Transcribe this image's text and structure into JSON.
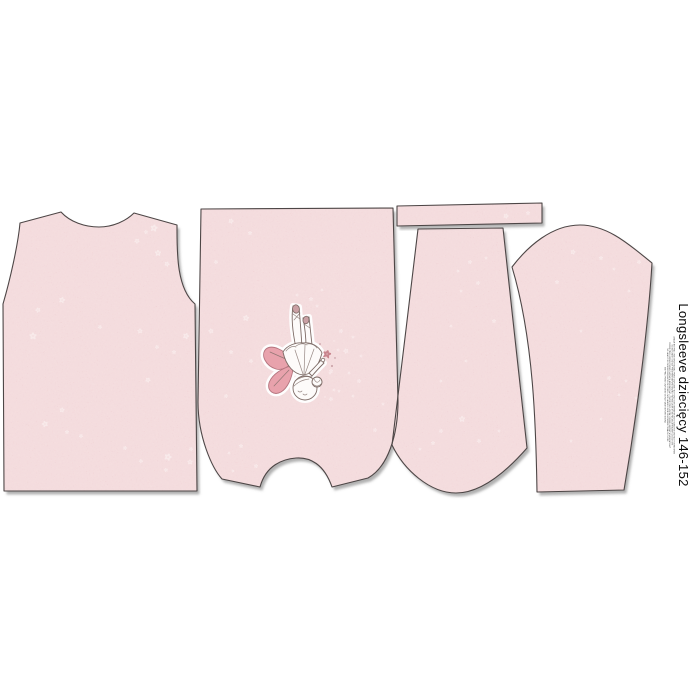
{
  "image": {
    "background": "#ffffff",
    "description": "Printed fabric sewing panel preview with cut pattern pieces"
  },
  "label": {
    "title": "Longsleeve dziecięcy 146-152",
    "care_lines": [
      "UWAGA! NIE PRAĆ I NIE DEKATYZOWAĆ PRZED USZYCIEM • ACHTUNG! VOR DEM NÄHEN NICHT WASCHEN UND NICHT DEKATIEREN",
      "DO NOT WASH / DO NOT PRESHRINK BEFORE SEWING • NE PAS LAVER ET NE PAS DÉCATIR AVANT LA COUTURE",
      "POZOR! PŘED UŠITÍM VÝROBKU NEPRAT A NEDEKATOVAT • POZOR! PRED UŠITÍM VÝROBKU NEPRAŤ A NEDEKATOVAŤ",
      "NO LAVAR Y NO DESENCOGER ANTES DE COSER • NON LAVARE E NON DECATIZZARE PRIMA DI CUCIRE",
      "NIE PRAĆ PRZED USZYCIEM / DO NOT WASH BEFORE SEWING"
    ]
  },
  "fabric": {
    "base_color": "#efc6c9",
    "star_stroke": "#f9ebec",
    "star_fill": "#f2d2d4",
    "outline_color": "#4d4646",
    "shadow_color": "#6f6f6f"
  },
  "fairy": {
    "wing_color": "#e8a2ac",
    "wing_outline": "#b5747e",
    "body_color": "#fdfbfa",
    "line_color": "#7d6b66",
    "wand_star_fill": "#f3c9ce",
    "wand_star_stroke": "#c9858e"
  },
  "stars": [
    [
      154,
      228,
      7,
      10
    ],
    [
      137,
      241,
      5,
      40
    ],
    [
      158,
      253,
      6,
      0
    ],
    [
      167,
      264,
      5,
      25
    ],
    [
      146,
      232,
      4,
      60
    ],
    [
      62,
      300,
      6,
      15
    ],
    [
      38,
      310,
      5,
      50
    ],
    [
      33,
      336,
      7,
      0
    ],
    [
      100,
      327,
      4,
      30
    ],
    [
      140,
      331,
      5,
      70
    ],
    [
      186,
      336,
      6,
      20
    ],
    [
      157,
      347,
      4,
      45
    ],
    [
      174,
      352,
      4,
      0
    ],
    [
      148,
      380,
      5,
      30
    ],
    [
      62,
      410,
      5,
      10
    ],
    [
      45,
      424,
      6,
      55
    ],
    [
      67,
      432,
      4,
      0
    ],
    [
      81,
      436,
      4,
      35
    ],
    [
      168,
      457,
      7,
      20
    ],
    [
      190,
      462,
      5,
      0
    ],
    [
      166,
      470,
      4,
      60
    ],
    [
      191,
      449,
      4,
      30
    ],
    [
      125,
      448,
      4,
      15
    ],
    [
      141,
      461,
      4,
      45
    ],
    [
      231,
      221,
      5,
      20
    ],
    [
      250,
      233,
      4,
      0
    ],
    [
      216,
      262,
      4,
      45
    ],
    [
      246,
      318,
      6,
      10
    ],
    [
      211,
      331,
      5,
      60
    ],
    [
      231,
      352,
      4,
      0
    ],
    [
      251,
      361,
      4,
      30
    ],
    [
      226,
      396,
      4,
      15
    ],
    [
      311,
      299,
      4,
      0
    ],
    [
      322,
      290,
      3,
      40
    ],
    [
      341,
      331,
      4,
      20
    ],
    [
      353,
      337,
      3,
      0
    ],
    [
      346,
      351,
      5,
      50
    ],
    [
      361,
      356,
      3,
      10
    ],
    [
      331,
      371,
      4,
      0
    ],
    [
      349,
      373,
      3,
      30
    ],
    [
      359,
      381,
      4,
      15
    ],
    [
      339,
      391,
      3,
      0
    ],
    [
      331,
      399,
      4,
      45
    ],
    [
      353,
      396,
      3,
      20
    ],
    [
      241,
      446,
      4,
      0
    ],
    [
      229,
      453,
      3,
      30
    ],
    [
      256,
      466,
      4,
      10
    ],
    [
      233,
      471,
      3,
      50
    ],
    [
      288,
      477,
      4,
      0
    ],
    [
      305,
      470,
      3,
      25
    ],
    [
      375,
      430,
      4,
      15
    ],
    [
      383,
      404,
      3,
      0
    ],
    [
      506,
      216,
      5,
      20
    ],
    [
      528,
      213,
      4,
      0
    ],
    [
      470,
      262,
      4,
      10
    ],
    [
      486,
      258,
      3,
      0
    ],
    [
      458,
      271,
      3,
      45
    ],
    [
      478,
      283,
      4,
      20
    ],
    [
      461,
      291,
      3,
      0
    ],
    [
      451,
      326,
      3,
      30
    ],
    [
      494,
      321,
      4,
      0
    ],
    [
      466,
      361,
      3,
      15
    ],
    [
      441,
      381,
      3,
      50
    ],
    [
      462,
      419,
      6,
      0
    ],
    [
      441,
      431,
      4,
      25
    ],
    [
      433,
      443,
      4,
      0
    ],
    [
      479,
      441,
      4,
      40
    ],
    [
      499,
      431,
      3,
      10
    ],
    [
      420,
      449,
      3,
      0
    ],
    [
      573,
      252,
      5,
      15
    ],
    [
      601,
      258,
      4,
      0
    ],
    [
      639,
      262,
      4,
      30
    ],
    [
      614,
      269,
      3,
      10
    ],
    [
      557,
      282,
      4,
      0
    ],
    [
      629,
      291,
      3,
      45
    ],
    [
      581,
      331,
      3,
      0
    ],
    [
      609,
      378,
      4,
      20
    ],
    [
      626,
      381,
      3,
      0
    ],
    [
      619,
      395,
      3,
      35
    ],
    [
      636,
      398,
      3,
      0
    ],
    [
      601,
      419,
      3,
      15
    ],
    [
      571,
      441,
      3,
      0
    ],
    [
      648,
      339,
      3,
      25
    ],
    [
      330,
      373,
      3,
      0
    ],
    [
      334,
      390,
      3,
      20
    ],
    [
      325,
      397,
      2,
      0
    ],
    [
      338,
      350,
      3,
      10
    ],
    [
      334,
      341,
      2,
      0
    ],
    [
      317,
      306,
      3,
      0
    ],
    [
      297,
      295,
      3,
      15
    ]
  ]
}
